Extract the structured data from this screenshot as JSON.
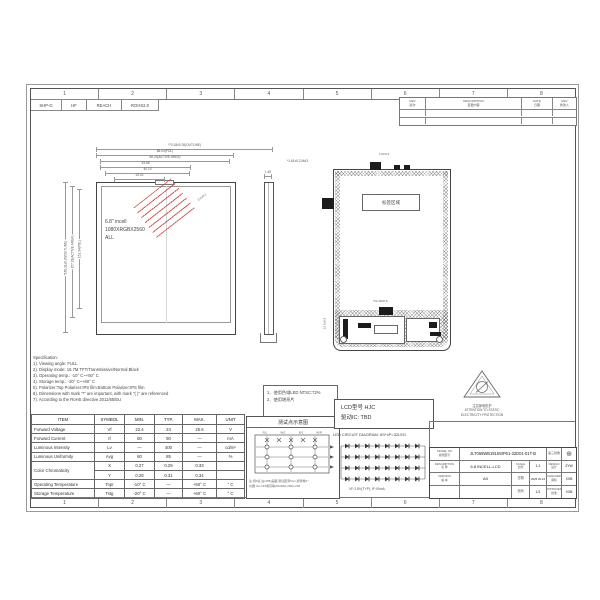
{
  "colors": {
    "line": "#555555",
    "stamp_red": "#c23b32"
  },
  "grid_numbers": [
    "1",
    "2",
    "3",
    "4",
    "5",
    "6",
    "7",
    "8"
  ],
  "compliance": [
    "SHP-G",
    "HF",
    "REACH",
    "ROHS2.0"
  ],
  "revision_table": {
    "headers": [
      {
        "en": "REV",
        "cn": "版次"
      },
      {
        "en": "DESCRIPTION",
        "cn": "变更内容"
      },
      {
        "en": "DATE",
        "cn": "日期"
      },
      {
        "en": "REV",
        "cn": "修改人"
      }
    ]
  },
  "front_view": {
    "display_lines": [
      "6.8\" incell",
      "1080XRGBX2560",
      "ALL"
    ],
    "dims_top": [
      "*70.18±0.20(OUTLINE)",
      "68.04(POL)",
      "66.24(ACTIVE AREA)",
      "43.58",
      "40.10",
      "33.02"
    ],
    "dims_left": [
      "*160.11±0.20(OUTLINE)",
      "157.01(ACTIVE AREA)",
      "151.34(POL)"
    ],
    "stamp_note": "0.2±0.1"
  },
  "side_view": {
    "top_dim": "1.45",
    "note": "*1.61±0.2 MAX"
  },
  "back_view": {
    "label": "标签区域",
    "top_dim": "1.0±0.3",
    "bottom_dim": "*22.15±0.5",
    "left_dim": "12.5±0.5"
  },
  "spec_notes": [
    "Specification:",
    "1). Viewing angle: FULL",
    "2). Display mode: 16.7M TFT/Transmissive/Normal Black",
    "3). Operating temp.: -10° C~+50° C",
    "4). Storage temp.: -20° C~+60° C",
    "5). Polarizer:Top Polarizer:IPS film;Bottom Polarizer:IPS film",
    "6). Dimensions with mark \"*\" are important, with mark \"( )\" are referenced",
    "7). According to the RoHS directive 2011/65/EU"
  ],
  "usage_notes": [
    "1、使用色域LED NTSC:72%",
    "2、使用增亮片"
  ],
  "spec_table": {
    "headers": [
      "ITEM",
      "SYMBOL",
      "MIN.",
      "TYP.",
      "MAX.",
      "UNIT"
    ],
    "rows": [
      [
        "Forward Voltage",
        "Vf",
        "22.4",
        "24",
        "25.6",
        "V"
      ],
      [
        "Forward Current",
        "If",
        "80",
        "90",
        "—",
        "mA"
      ],
      [
        "Luminous Intensity",
        "Lv",
        "—",
        "400",
        "—",
        "cd/m²"
      ],
      [
        "Luminous Uniformity",
        "Avg",
        "80",
        "85",
        "—",
        "%"
      ],
      [
        "Color Chromaticity",
        "X",
        "0.27",
        "0.29",
        "0.33",
        ""
      ],
      [
        "",
        "Y",
        "0.28",
        "0.31",
        "0.34",
        ""
      ],
      [
        "Operating Temperature",
        "Topr",
        "-10° C",
        "—",
        "+50° C",
        "° C"
      ],
      [
        "Storage Temperature",
        "Tstg",
        "-20° C",
        "—",
        "+60° C",
        "° C"
      ]
    ]
  },
  "test_point": {
    "title": "测试点示意图",
    "top_labels": [
      "R/L",
      "W/1",
      "B/1",
      "W/R"
    ],
    "notes": [
      "注:测9点,白(255)画面,测试距离5cm,视场角1°",
      "仪器:CA-310或同等(MODEL),B0A-250"
    ]
  },
  "lcd_info": {
    "line1": "LCD型号 HJC",
    "line2": "驱动IC: TBD"
  },
  "led_circuit": {
    "label": "LED CIRCUIT DIAGRAM: 8S*4P=32LED",
    "rows": 4,
    "cols": 8,
    "note": "VF:2.8V(TYP), IF:90mA"
  },
  "esd": {
    "cn": "注意静电防护",
    "en1": "ATTENTION TO STATIC",
    "en2": "ELECTRICITY PROTECTION"
  },
  "title_block": {
    "model_label_en": "MODEL NO",
    "model_label_cn": "模组型号",
    "model": "JLT068WB1916WP61-32D01-01T-B",
    "desc_label_en": "DESCRIPTION",
    "desc_label_cn": "名 称",
    "description": "6.8 INCELL-LCD",
    "version_label_en": "VERSION",
    "version_label_cn": "版 本",
    "version": "A0",
    "scale_label_en": "SCALE",
    "scale_label_cn": "比例",
    "scale": "1:1",
    "date_label_cn": "日期",
    "date": "2025.04.24",
    "page_label_cn": "页码",
    "page": "1/1",
    "angle_label": "第三视角",
    "projection_symbol": "⊕",
    "design_label_en": "DESIGN",
    "design_label_cn": "设计",
    "design": "ZYW",
    "checked_label_en": "CHECKED",
    "checked_label_cn": "审核",
    "checked": "XXB",
    "approved_label_en": "APPROVED",
    "approved_label_cn": "批准",
    "approved": "XXB"
  }
}
